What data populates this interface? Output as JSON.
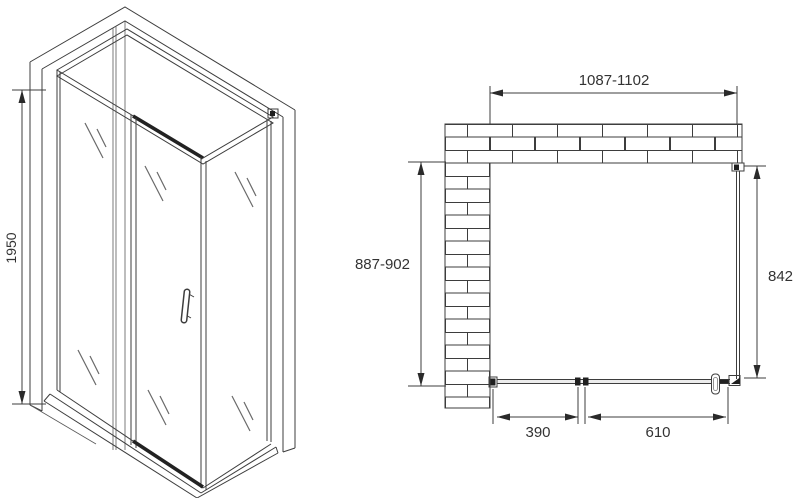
{
  "drawing": {
    "title": "shower-enclosure-technical-drawing",
    "iso_view": {
      "height_dim": "1950"
    },
    "plan_view": {
      "width_dim": "1087-1102",
      "depth_dim": "887-902",
      "side_panel_dim": "842",
      "fixed_section_dim": "390",
      "door_section_dim": "610"
    },
    "colors": {
      "line": "#3d3d3d",
      "dark_fittings": "#1f1f1f",
      "glass_mark": "#6a6a6a",
      "text": "#333333",
      "background": "#ffffff",
      "brick_fill": "#ffffff"
    }
  }
}
